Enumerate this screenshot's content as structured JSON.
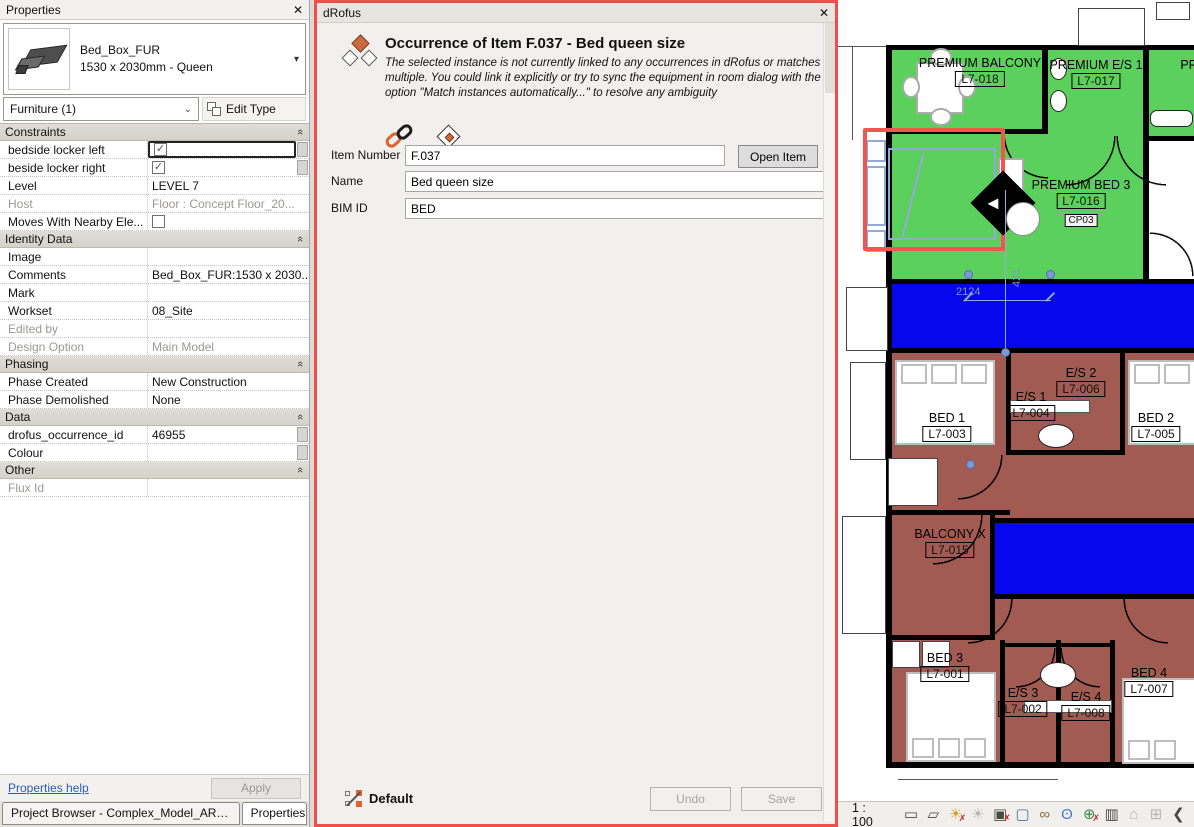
{
  "icons": {
    "close": "✕",
    "dropdown": "▾",
    "combo": "⌄",
    "section_collapse": "«",
    "check": "✓"
  },
  "properties_panel": {
    "title": "Properties",
    "type_selector": {
      "family": "Bed_Box_FUR",
      "type": "1530 x 2030mm - Queen"
    },
    "filter": {
      "category": "Furniture (1)",
      "edit_type_label": "Edit Type"
    },
    "sections": [
      {
        "title": "Constraints",
        "rows": [
          {
            "label": "bedside locker left",
            "value": "",
            "checkbox": "checked",
            "active": true,
            "assoc": true
          },
          {
            "label": "beside locker right",
            "value": "",
            "checkbox": "checked",
            "assoc": true
          },
          {
            "label": "Level",
            "value": "LEVEL 7"
          },
          {
            "label": "Host",
            "value": "Floor : Concept Floor_20...",
            "disabled": true
          },
          {
            "label": "Moves With Nearby Ele...",
            "value": "",
            "checkbox": "unchecked"
          }
        ]
      },
      {
        "title": "Identity Data",
        "rows": [
          {
            "label": "Image",
            "value": ""
          },
          {
            "label": "Comments",
            "value": "Bed_Box_FUR:1530 x 2030..."
          },
          {
            "label": "Mark",
            "value": ""
          },
          {
            "label": "Workset",
            "value": "08_Site"
          },
          {
            "label": "Edited by",
            "value": "",
            "disabled": true
          },
          {
            "label": "Design Option",
            "value": "Main Model",
            "disabled": true
          }
        ]
      },
      {
        "title": "Phasing",
        "rows": [
          {
            "label": "Phase Created",
            "value": "New Construction"
          },
          {
            "label": "Phase Demolished",
            "value": "None"
          }
        ]
      },
      {
        "title": "Data",
        "rows": [
          {
            "label": "drofus_occurrence_id",
            "value": "46955",
            "assoc": true
          },
          {
            "label": "Colour",
            "value": "",
            "assoc": true
          }
        ]
      },
      {
        "title": "Other",
        "rows": [
          {
            "label": "Flux Id",
            "value": "",
            "disabled": true
          }
        ]
      }
    ],
    "help_link": "Properties help",
    "apply_label": "Apply",
    "tabs": [
      {
        "label": "Project Browser - Complex_Model_ARCH_Wi...",
        "active": false
      },
      {
        "label": "Properties",
        "active": true
      }
    ]
  },
  "drofus_dialog": {
    "title": "dRofus",
    "heading": "Occurrence of Item F.037 - Bed queen size",
    "description": "The selected instance is not currently linked to any occurrences in dRofus or matches multiple. You could link it explicitly or try to sync the equipment in room dialog with the option \"Match instances automatically...\" to resolve any ambiguity",
    "fields": [
      {
        "label": "Item Number",
        "value": "F.037",
        "button": "Open Item"
      },
      {
        "label": "Name",
        "value": "Bed queen size"
      },
      {
        "label": "BIM ID",
        "value": "BED"
      }
    ],
    "footer": {
      "layout_label": "Default",
      "undo_label": "Undo",
      "save_label": "Save"
    }
  },
  "plan_view": {
    "colors": {
      "room_green": "#5cd05c",
      "room_maroon": "#a25b53",
      "corridor_blue": "#0707ee",
      "selection": "#93a9d9",
      "highlight_red": "#f05550"
    },
    "rooms": [
      {
        "name": "PREMIUM BALCONY",
        "tag": "L7-018",
        "x": 142,
        "y": 56
      },
      {
        "name": "PREMIUM E/S 1",
        "tag": "L7-017",
        "x": 258,
        "y": 58
      },
      {
        "name": "PR",
        "tag": "",
        "x": 351,
        "y": 58
      },
      {
        "name": "PREMIUM BED 3",
        "tag": "L7-016",
        "tag2": "CP03",
        "x": 243,
        "y": 178
      },
      {
        "name": "BED 1",
        "tag": "L7-003",
        "x": 109,
        "y": 411
      },
      {
        "name": "E/S 2",
        "tag": "L7-006",
        "x": 243,
        "y": 366
      },
      {
        "name": "E/S 1",
        "tag": "L7-004",
        "x": 193,
        "y": 390
      },
      {
        "name": "BED 2",
        "tag": "L7-005",
        "x": 318,
        "y": 411
      },
      {
        "name": "BALCONY X",
        "tag": "L7-015",
        "x": 112,
        "y": 527
      },
      {
        "name": "BED 3",
        "tag": "L7-001",
        "x": 107,
        "y": 651
      },
      {
        "name": "E/S 3",
        "tag": "L7-002",
        "x": 185,
        "y": 686
      },
      {
        "name": "E/S 4",
        "tag": "L7-008",
        "x": 248,
        "y": 690
      },
      {
        "name": "BED 4",
        "tag": "L7-007",
        "x": 311,
        "y": 666
      }
    ],
    "dimension_text": "2124",
    "dimension_text_vertical": "421",
    "status_bar": {
      "scale": "1 : 100",
      "icons": [
        {
          "name": "detail-level-icon",
          "glyph": "▭",
          "color": "#4a4a42"
        },
        {
          "name": "visual-style-icon",
          "glyph": "▱",
          "color": "#4a4a42"
        },
        {
          "name": "sun-path-icon",
          "glyph": "☀",
          "color": "#d6a028",
          "badge": "✗"
        },
        {
          "name": "shadows-icon",
          "glyph": "☀",
          "color": "#b8b5ae"
        },
        {
          "name": "crop-view-icon",
          "glyph": "▣",
          "color": "#4a4a42",
          "badge": "✗"
        },
        {
          "name": "show-crop-region-icon",
          "glyph": "▢",
          "color": "#4a6fa5"
        },
        {
          "name": "reveal-hidden-elements-icon",
          "glyph": "∞",
          "color": "#8a6f3a"
        },
        {
          "name": "temporary-view-properties-icon",
          "glyph": "ʘ",
          "color": "#3f7bc4"
        },
        {
          "name": "worksharing-display-icon",
          "glyph": "⊕",
          "color": "#3a8a4a",
          "badge": "✗"
        },
        {
          "name": "displaced-elements-icon",
          "glyph": "▥",
          "color": "#4a4a42"
        },
        {
          "name": "analytical-model-icon",
          "glyph": "⌂",
          "color": "#b8b5ae"
        },
        {
          "name": "constraints-icon",
          "glyph": "⊞",
          "color": "#b8b5ae"
        },
        {
          "name": "collapse-icon",
          "glyph": "❮",
          "color": "#4a4a42"
        }
      ]
    }
  }
}
